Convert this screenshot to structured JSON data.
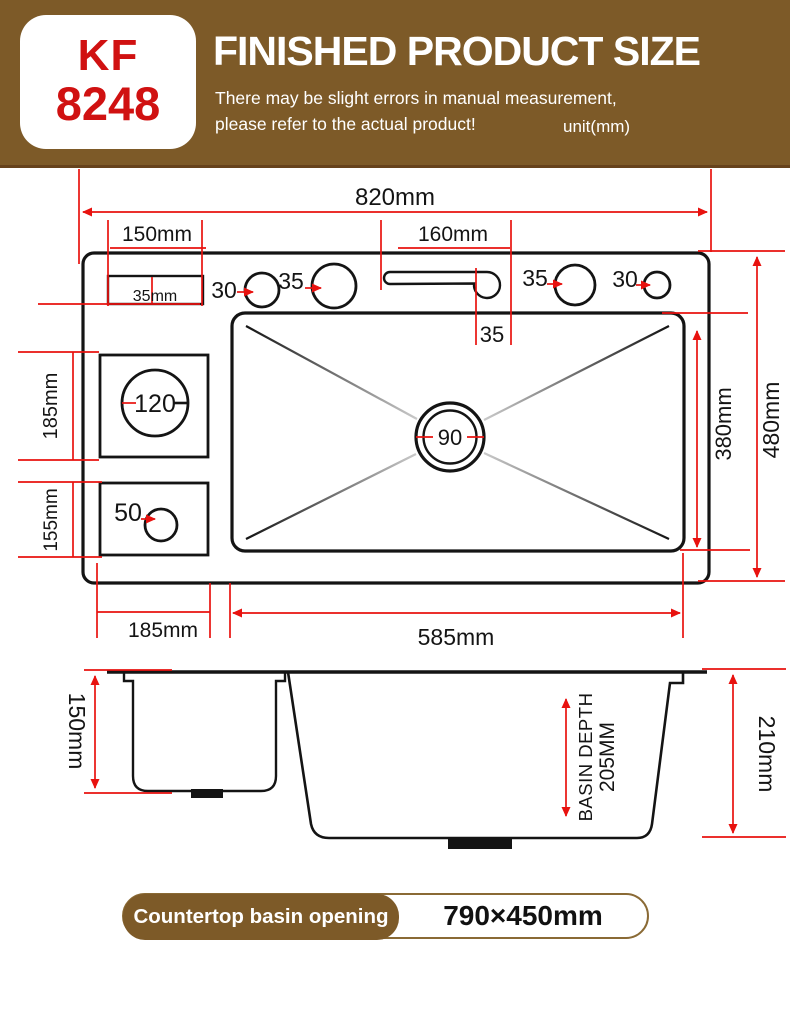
{
  "header": {
    "model_top": "KF",
    "model_bottom": "8248",
    "title": "FINISHED PRODUCT SIZE",
    "note_line1": "There may be slight errors in manual measurement,",
    "note_line2": "please refer to the actual product!",
    "unit": "unit(mm)"
  },
  "top_view": {
    "dim_820": "820mm",
    "dim_150": "150mm",
    "dim_160": "160mm",
    "dim_35mm": "35mm",
    "hole_30_left": "30",
    "hole_35_left": "35",
    "dim_35_slot": "35",
    "hole_35_right": "35",
    "hole_30_right": "30",
    "hole_120": "120",
    "hole_50": "50",
    "drain_90": "90",
    "dim_185_left": "185mm",
    "dim_155_left": "155mm",
    "dim_380": "380mm",
    "dim_480": "480mm",
    "dim_185_bottom": "185mm",
    "dim_585": "585mm"
  },
  "side_view": {
    "dim_150": "150mm",
    "basin_depth_line1": "BASIN DEPTH",
    "basin_depth_line2": "205MM",
    "dim_210": "210mm"
  },
  "footer": {
    "label": "Countertop basin opening",
    "value": "790×450mm"
  },
  "colors": {
    "header_brown": "#7d5a28",
    "accent_red": "#e8120f",
    "model_red": "#d01111",
    "line_black": "#141414"
  }
}
